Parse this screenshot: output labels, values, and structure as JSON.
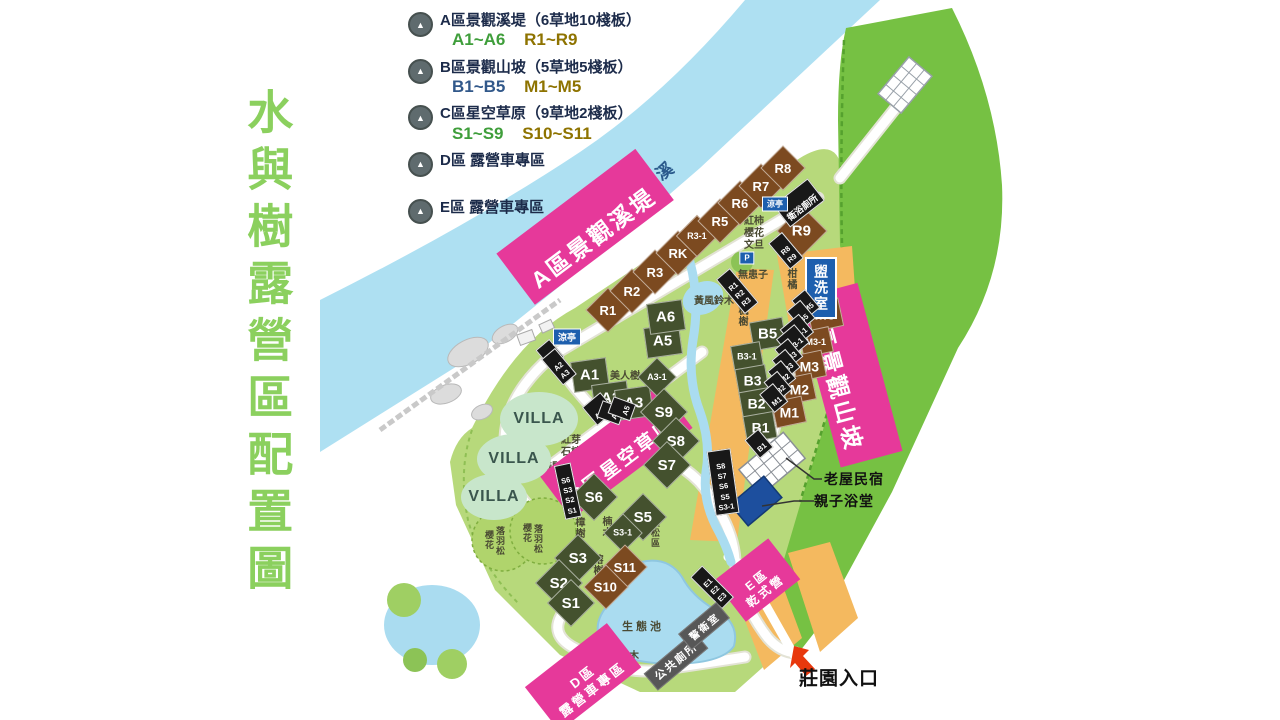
{
  "title": {
    "text": "水與樹露營區配置圖"
  },
  "river": {
    "name": "蓬萊溪"
  },
  "colors": {
    "title_green": "#8bd05e",
    "banner_pink": "#e6399a",
    "grass_plot": "#44512e",
    "deck_plot": "#7c4a20",
    "river_blue": "#aee0f2",
    "field_green": "#b7d97b",
    "hill_green": "#76c143",
    "orange_zone": "#f4b95f",
    "facility_blue": "#1d5fae",
    "entrance_arrow_red": "#e8380d"
  },
  "legend": {
    "items": [
      {
        "title": "A區景觀溪堤（6草地10棧板）",
        "c1": "A1~A6",
        "c2": "R1~R9",
        "c1c": "#3f9e3b"
      },
      {
        "title": "B區景觀山坡（5草地5棧板）",
        "c1": "B1~B5",
        "c2": "M1~M5",
        "c1c": "#31588a"
      },
      {
        "title": "C區星空草原（9草地2棧板）",
        "c1": "S1~S9",
        "c2": "S10~S11",
        "c1c": "#3f9e3b"
      },
      {
        "title": "D區 露營車專區"
      },
      {
        "title": "E區 露營車專區"
      }
    ]
  },
  "banners": [
    {
      "label": "A區景觀溪堤",
      "x": 585,
      "y": 227,
      "rot": -37,
      "fs": 23
    },
    {
      "label": "B區景觀山坡",
      "x": 849,
      "y": 375,
      "rot": 75,
      "fs": 23
    },
    {
      "label": "C區星空草原",
      "x": 616,
      "y": 452,
      "rot": -37,
      "fs": 19
    },
    {
      "label": "D區\n露營車專區",
      "x": 583,
      "y": 677,
      "rot": -38,
      "fs": 13
    },
    {
      "label": "E區\n乾式營",
      "x": 757,
      "y": 580,
      "rot": -38,
      "fs": 12
    }
  ],
  "plots": [
    {
      "label": "R1",
      "x": 608,
      "y": 310,
      "cls": "d b",
      "w": 30,
      "fs": 13
    },
    {
      "label": "R2",
      "x": 632,
      "y": 291,
      "cls": "d b",
      "w": 30,
      "fs": 13
    },
    {
      "label": "R3",
      "x": 655,
      "y": 272,
      "cls": "d b",
      "w": 30,
      "fs": 13
    },
    {
      "label": "RK",
      "x": 678,
      "y": 253,
      "cls": "d b",
      "w": 30,
      "fs": 13
    },
    {
      "label": "R3-1",
      "x": 697,
      "y": 236,
      "cls": "d b",
      "w": 28,
      "fs": 9
    },
    {
      "label": "R5",
      "x": 720,
      "y": 221,
      "cls": "d b",
      "w": 30,
      "fs": 13
    },
    {
      "label": "R6",
      "x": 740,
      "y": 203,
      "cls": "d b",
      "w": 30,
      "fs": 13
    },
    {
      "label": "R7",
      "x": 761,
      "y": 186,
      "cls": "d b",
      "w": 30,
      "fs": 13
    },
    {
      "label": "R8",
      "x": 783,
      "y": 168,
      "cls": "d b",
      "w": 30,
      "fs": 13
    },
    {
      "label": "R9",
      "x": 802,
      "y": 231,
      "cls": "d b",
      "w": 34,
      "fs": 15
    },
    {
      "label": "A1",
      "x": 590,
      "y": 375,
      "cls": "sq g",
      "w": 34,
      "h": 29,
      "rot": -8,
      "fs": 15
    },
    {
      "label": "A2",
      "x": 611,
      "y": 398,
      "cls": "sq g",
      "w": 34,
      "h": 29,
      "rot": -8,
      "fs": 15
    },
    {
      "label": "A3",
      "x": 634,
      "y": 403,
      "cls": "sq g",
      "w": 34,
      "h": 29,
      "rot": -8,
      "fs": 15
    },
    {
      "label": "A3-1",
      "x": 657,
      "y": 377,
      "cls": "d g",
      "w": 26,
      "fs": 9
    },
    {
      "label": "A5",
      "x": 663,
      "y": 341,
      "cls": "sq g",
      "w": 34,
      "h": 29,
      "rot": -8,
      "fs": 15
    },
    {
      "label": "A6",
      "x": 666,
      "y": 317,
      "cls": "sq g",
      "w": 34,
      "h": 29,
      "rot": -8,
      "fs": 15
    },
    {
      "label": "S9",
      "x": 664,
      "y": 412,
      "cls": "d g",
      "w": 32,
      "fs": 15
    },
    {
      "label": "S8",
      "x": 676,
      "y": 441,
      "cls": "d g",
      "w": 32,
      "fs": 15
    },
    {
      "label": "S7",
      "x": 667,
      "y": 465,
      "cls": "d g",
      "w": 32,
      "fs": 15
    },
    {
      "label": "S6",
      "x": 594,
      "y": 497,
      "cls": "d g",
      "w": 32,
      "fs": 15
    },
    {
      "label": "S5",
      "x": 643,
      "y": 517,
      "cls": "d g",
      "w": 32,
      "fs": 15
    },
    {
      "label": "S3-1",
      "x": 623,
      "y": 533,
      "cls": "d g",
      "w": 26,
      "fs": 9
    },
    {
      "label": "S3",
      "x": 578,
      "y": 558,
      "cls": "d g",
      "w": 32,
      "fs": 15
    },
    {
      "label": "S2",
      "x": 559,
      "y": 583,
      "cls": "d g",
      "w": 32,
      "fs": 15
    },
    {
      "label": "S1",
      "x": 571,
      "y": 603,
      "cls": "d g",
      "w": 32,
      "fs": 15
    },
    {
      "label": "S11",
      "x": 625,
      "y": 567,
      "cls": "d b",
      "w": 30,
      "fs": 13
    },
    {
      "label": "S10",
      "x": 606,
      "y": 587,
      "cls": "d b",
      "w": 30,
      "fs": 13
    },
    {
      "label": "B5",
      "x": 768,
      "y": 334,
      "cls": "sq g",
      "w": 32,
      "h": 27,
      "rot": -10,
      "fs": 15
    },
    {
      "label": "B3-1",
      "x": 747,
      "y": 356,
      "cls": "sq g",
      "w": 28,
      "h": 23,
      "rot": -10,
      "fs": 9
    },
    {
      "label": "B3",
      "x": 752,
      "y": 380,
      "cls": "sq g",
      "w": 29,
      "h": 25,
      "rot": -10,
      "fs": 14
    },
    {
      "label": "B2",
      "x": 756,
      "y": 403,
      "cls": "sq g",
      "w": 29,
      "h": 25,
      "rot": -10,
      "fs": 14
    },
    {
      "label": "B1",
      "x": 760,
      "y": 427,
      "cls": "sq g",
      "w": 29,
      "h": 25,
      "rot": -10,
      "fs": 14
    },
    {
      "label": "M5",
      "x": 825,
      "y": 315,
      "cls": "sq b",
      "w": 31,
      "h": 27,
      "rot": -12,
      "fs": 15
    },
    {
      "label": "M3-1",
      "x": 816,
      "y": 342,
      "cls": "sq b",
      "w": 29,
      "h": 24,
      "rot": -12,
      "fs": 9
    },
    {
      "label": "M3",
      "x": 809,
      "y": 366,
      "cls": "sq b",
      "w": 29,
      "h": 25,
      "rot": -12,
      "fs": 14
    },
    {
      "label": "M2",
      "x": 799,
      "y": 389,
      "cls": "sq b",
      "w": 29,
      "h": 25,
      "rot": -12,
      "fs": 14
    },
    {
      "label": "M1",
      "x": 789,
      "y": 412,
      "cls": "sq b",
      "w": 29,
      "h": 25,
      "rot": -12,
      "fs": 14
    }
  ],
  "badges": [
    {
      "label": "A1",
      "x": 550,
      "y": 354,
      "rot": -40
    },
    {
      "label": "A2\nA3",
      "x": 559,
      "y": 367,
      "rot": -40
    },
    {
      "label": "A3-1",
      "x": 599,
      "y": 409,
      "rot": -40
    },
    {
      "label": "A6",
      "x": 611,
      "y": 413,
      "rot": -70
    },
    {
      "label": "A5",
      "x": 622,
      "y": 409,
      "rot": -70
    },
    {
      "label": "R1\nR2\nR3",
      "x": 737,
      "y": 291,
      "rot": -40
    },
    {
      "label": "R8\nR9",
      "x": 786,
      "y": 251,
      "rot": -40
    },
    {
      "label": "衛浴廁所",
      "x": 799,
      "y": 203,
      "rot": -38,
      "fs": 9
    },
    {
      "label": "S6\nS3\nS2\nS1",
      "x": 568,
      "y": 491,
      "rot": -12
    },
    {
      "label": "S8\nS7\nS6\nS5\nS3-1",
      "x": 723,
      "y": 482,
      "rot": -8
    },
    {
      "label": "M5",
      "x": 806,
      "y": 304,
      "rot": -40
    },
    {
      "label": "B5",
      "x": 801,
      "y": 315,
      "rot": -40
    },
    {
      "label": "M3-1",
      "x": 797,
      "y": 331,
      "rot": -40
    },
    {
      "label": "B3-1",
      "x": 793,
      "y": 341,
      "rot": -40
    },
    {
      "label": "M3",
      "x": 789,
      "y": 353,
      "rot": -40
    },
    {
      "label": "B3",
      "x": 786,
      "y": 364,
      "rot": -40
    },
    {
      "label": "M2",
      "x": 782,
      "y": 375,
      "rot": -40
    },
    {
      "label": "B2",
      "x": 778,
      "y": 386,
      "rot": -40
    },
    {
      "label": "M1",
      "x": 774,
      "y": 398,
      "rot": -40
    },
    {
      "label": "B1",
      "x": 759,
      "y": 444,
      "rot": -40
    },
    {
      "label": "E1\nE2\nE3",
      "x": 712,
      "y": 587,
      "rot": -45
    }
  ],
  "blue_badges": [
    {
      "label": "涼亭",
      "x": 567,
      "y": 337,
      "fs": 9
    },
    {
      "label": "涼亭",
      "x": 775,
      "y": 204,
      "fs": 8
    },
    {
      "label": "P",
      "x": 747,
      "y": 258,
      "fs": 8
    }
  ],
  "washroom": {
    "label": "盥洗室"
  },
  "gray_buildings": [
    {
      "label": "公共廁所",
      "x": 676,
      "y": 661,
      "rot": -40,
      "fs": 11
    },
    {
      "label": "警衛室",
      "x": 704,
      "y": 626,
      "rot": -40,
      "fs": 10
    }
  ],
  "villas": [
    {
      "label": "VILLA",
      "x": 539,
      "y": 419,
      "w": 78,
      "h": 54
    },
    {
      "label": "VILLA",
      "x": 514,
      "y": 459,
      "w": 74,
      "h": 50
    },
    {
      "label": "VILLA",
      "x": 494,
      "y": 497,
      "w": 66,
      "h": 46
    }
  ],
  "trees": [
    {
      "label": "美人樹",
      "x": 625,
      "y": 371
    },
    {
      "label": "黃風鈴木",
      "x": 714,
      "y": 296
    },
    {
      "label": "黃風鈴木",
      "x": 619,
      "y": 651
    },
    {
      "label": "紅柿\n櫻花\n文旦",
      "x": 754,
      "y": 228
    },
    {
      "label": "無患子",
      "x": 753,
      "y": 270
    },
    {
      "label": "柑橘",
      "x": 796,
      "y": 279,
      "cls": "v"
    },
    {
      "label": "楓樹",
      "x": 747,
      "y": 316,
      "cls": "v"
    },
    {
      "label": "櫻花",
      "x": 652,
      "y": 400,
      "cls": "v"
    },
    {
      "label": "紅芽\n石楠",
      "x": 571,
      "y": 441
    },
    {
      "label": "接駁",
      "x": 552,
      "y": 462
    },
    {
      "label": "樟樹",
      "x": 584,
      "y": 528,
      "cls": "v"
    },
    {
      "label": "楠木",
      "x": 611,
      "y": 527,
      "cls": "v"
    },
    {
      "label": "榕樹",
      "x": 602,
      "y": 565,
      "cls": "v"
    },
    {
      "label": "五葉松區",
      "x": 660,
      "y": 528,
      "cls": "v",
      "fs": 9
    },
    {
      "label": "落羽松",
      "x": 505,
      "y": 541,
      "cls": "v",
      "fs": 9
    },
    {
      "label": "櫻花",
      "x": 494,
      "y": 540,
      "cls": "v",
      "fs": 9
    },
    {
      "label": "落羽松",
      "x": 543,
      "y": 539,
      "cls": "v",
      "fs": 9
    },
    {
      "label": "櫻花",
      "x": 532,
      "y": 533,
      "cls": "v",
      "fs": 9
    },
    {
      "label": "生態池",
      "x": 643,
      "y": 621,
      "fs": 11,
      "cls": "sp"
    }
  ],
  "poi": [
    {
      "label": "老屋民宿",
      "x": 854,
      "y": 479,
      "fs": 14
    },
    {
      "label": "親子浴堂",
      "x": 844,
      "y": 501,
      "fs": 14
    },
    {
      "label": "莊園入口",
      "x": 839,
      "y": 677,
      "fs": 19
    }
  ]
}
